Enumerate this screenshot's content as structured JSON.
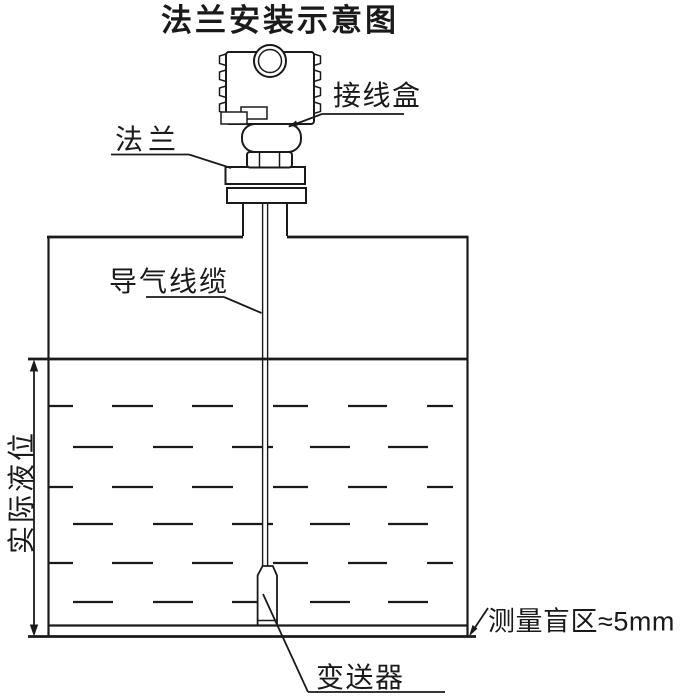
{
  "title": "法兰安装示意图",
  "colors": {
    "line": "#1a1a1a",
    "background": "#ffffff"
  },
  "labels": {
    "junction_box": "接线盒",
    "flange": "法兰",
    "vent_cable": "导气线缆",
    "actual_level": "实际液位",
    "transmitter": "变送器",
    "blind_zone": "测量盲区≈5mm"
  }
}
